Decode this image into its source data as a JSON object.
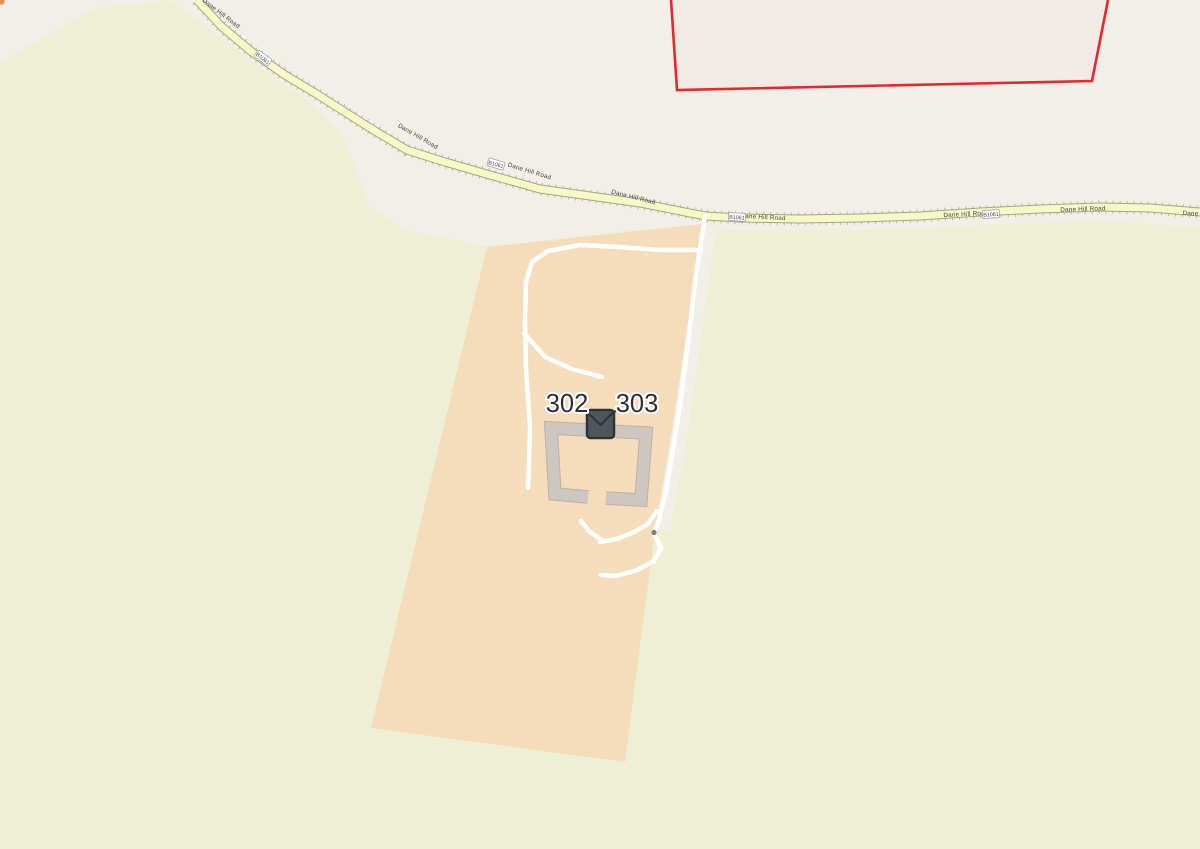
{
  "map": {
    "view": "openstreetmap-style map tile view",
    "housenumbers": [
      {
        "text": "302"
      },
      {
        "text": "303"
      }
    ],
    "road": {
      "name": "Dane Hill Road",
      "ref": "B1061",
      "labels": [
        {
          "text": "Dane Hill Road"
        },
        {
          "text": "Dane Hill Road"
        },
        {
          "text": "Dane Hill Road"
        },
        {
          "text": "Dane Hill Road"
        },
        {
          "text": "Dane Hill Road"
        },
        {
          "text": "Dane Hill Road"
        },
        {
          "text": "Dane Hill Road"
        },
        {
          "text": "Dane Hill Road"
        }
      ],
      "badges": [
        {
          "text": "B1061"
        },
        {
          "text": "B1061"
        },
        {
          "text": "B1061"
        },
        {
          "text": "B1061"
        }
      ]
    },
    "marker": {
      "icon": "envelope-icon"
    },
    "features": {
      "farmland": "farmland-area",
      "farmyard": "farmyard-area",
      "building": "u-shaped-building-outline",
      "paths": "service-driveways",
      "gate": "gate-node",
      "boundary": "red-boundary-polygon"
    },
    "colors": {
      "base_land": "#f2efe9",
      "farmland_green": "#eef0d5",
      "farmyard_peach": "#f5dcba",
      "road_fill": "#f6f9c6",
      "road_casing": "#a5a585",
      "path_white": "#ffffff",
      "building_gray": "#cdc6c1",
      "boundary_red": "#e8262b",
      "icon_dark": "#4f575a",
      "label_text": "#45453d",
      "housenumber_text": "#2e2e2e"
    }
  }
}
